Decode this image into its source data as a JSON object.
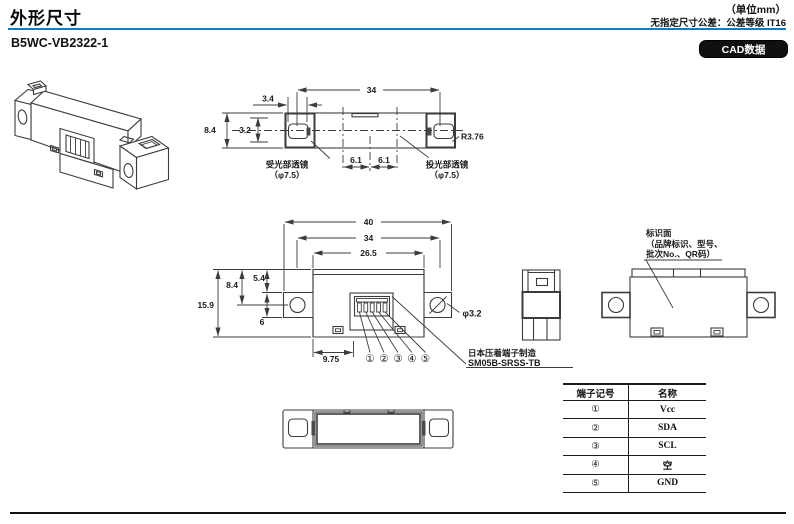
{
  "header": {
    "title": "外形尺寸",
    "unit_note": "（单位mm）",
    "tolerance_note": "无指定尺寸公差：公差等级 IT16",
    "model": "B5WC-VB2322-1",
    "cad_button_label": "CAD数据"
  },
  "colors": {
    "accent_blue": "#0d7ec1",
    "line_color": "#3c3c3c",
    "badge_bg": "#101010"
  },
  "top_view": {
    "dim_width": "34",
    "dim_lens_width": "3.4",
    "dim_height": "8.4",
    "dim_lens_height": "3.2",
    "dim_corner_radius": "R3.76",
    "dim_optical_left": "6.1",
    "dim_optical_right": "6.1",
    "receiver_lens_label": "受光部透镜",
    "receiver_lens_dia": "（φ7.5）",
    "emitter_lens_label": "投光部透镜",
    "emitter_lens_dia": "（φ7.5）"
  },
  "front_view": {
    "dim_total_width": "40",
    "dim_hole_pitch": "34",
    "dim_body_width": "26.5",
    "dim_total_height": "15.9",
    "dim_hole_center": "8.4",
    "dim_top_to_ear": "5.4",
    "dim_ear_height": "6",
    "dim_connector_offset": "9.75",
    "dim_hole_dia": "φ3.2",
    "pins": [
      "①",
      "②",
      "③",
      "④",
      "⑤"
    ],
    "connector_note_line1": "日本压着端子制造",
    "connector_note_line2": "SM05B-SRSS-TB"
  },
  "back_view": {
    "marking_label_line1": "标识面",
    "marking_label_line2": "（品牌标识、型号、",
    "marking_label_line3": "批次No.、QR码）"
  },
  "terminal_table": {
    "headers": [
      "端子记号",
      "名称"
    ],
    "rows": [
      {
        "mark": "①",
        "name": "Vcc"
      },
      {
        "mark": "②",
        "name": "SDA"
      },
      {
        "mark": "③",
        "name": "SCL"
      },
      {
        "mark": "④",
        "name": "空"
      },
      {
        "mark": "⑤",
        "name": "GND"
      }
    ]
  }
}
